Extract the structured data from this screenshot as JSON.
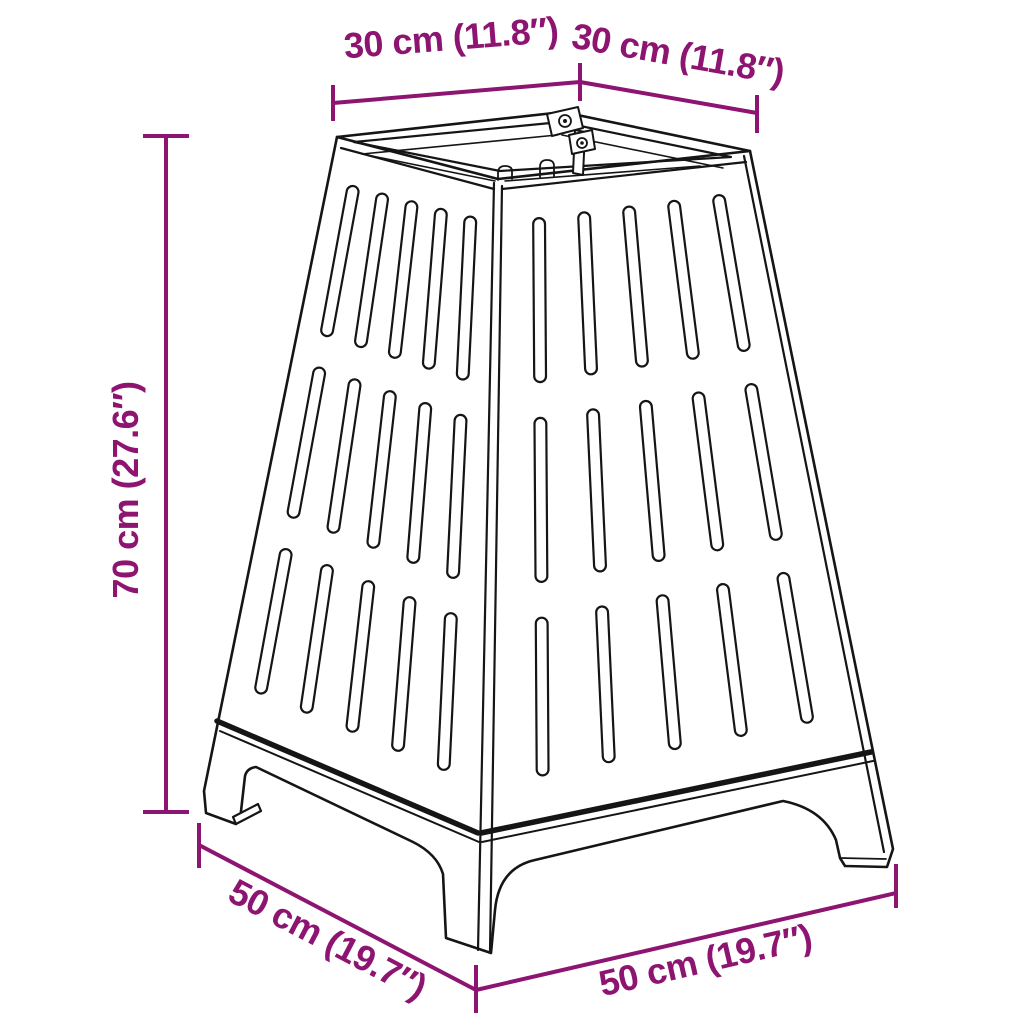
{
  "diagram": {
    "subject": "slotted-fire-basket-with-leg-base",
    "colors": {
      "dimension_accent": "#8D1470",
      "line": "#151515",
      "background": "#FFFFFF"
    },
    "labels": {
      "top_width": "30 cm (11.8″)",
      "top_depth": "30 cm (11.8″)",
      "height": "70 cm (27.6″)",
      "base_depth": "50 cm (19.7″)",
      "base_width": "50 cm (19.7″)"
    }
  }
}
